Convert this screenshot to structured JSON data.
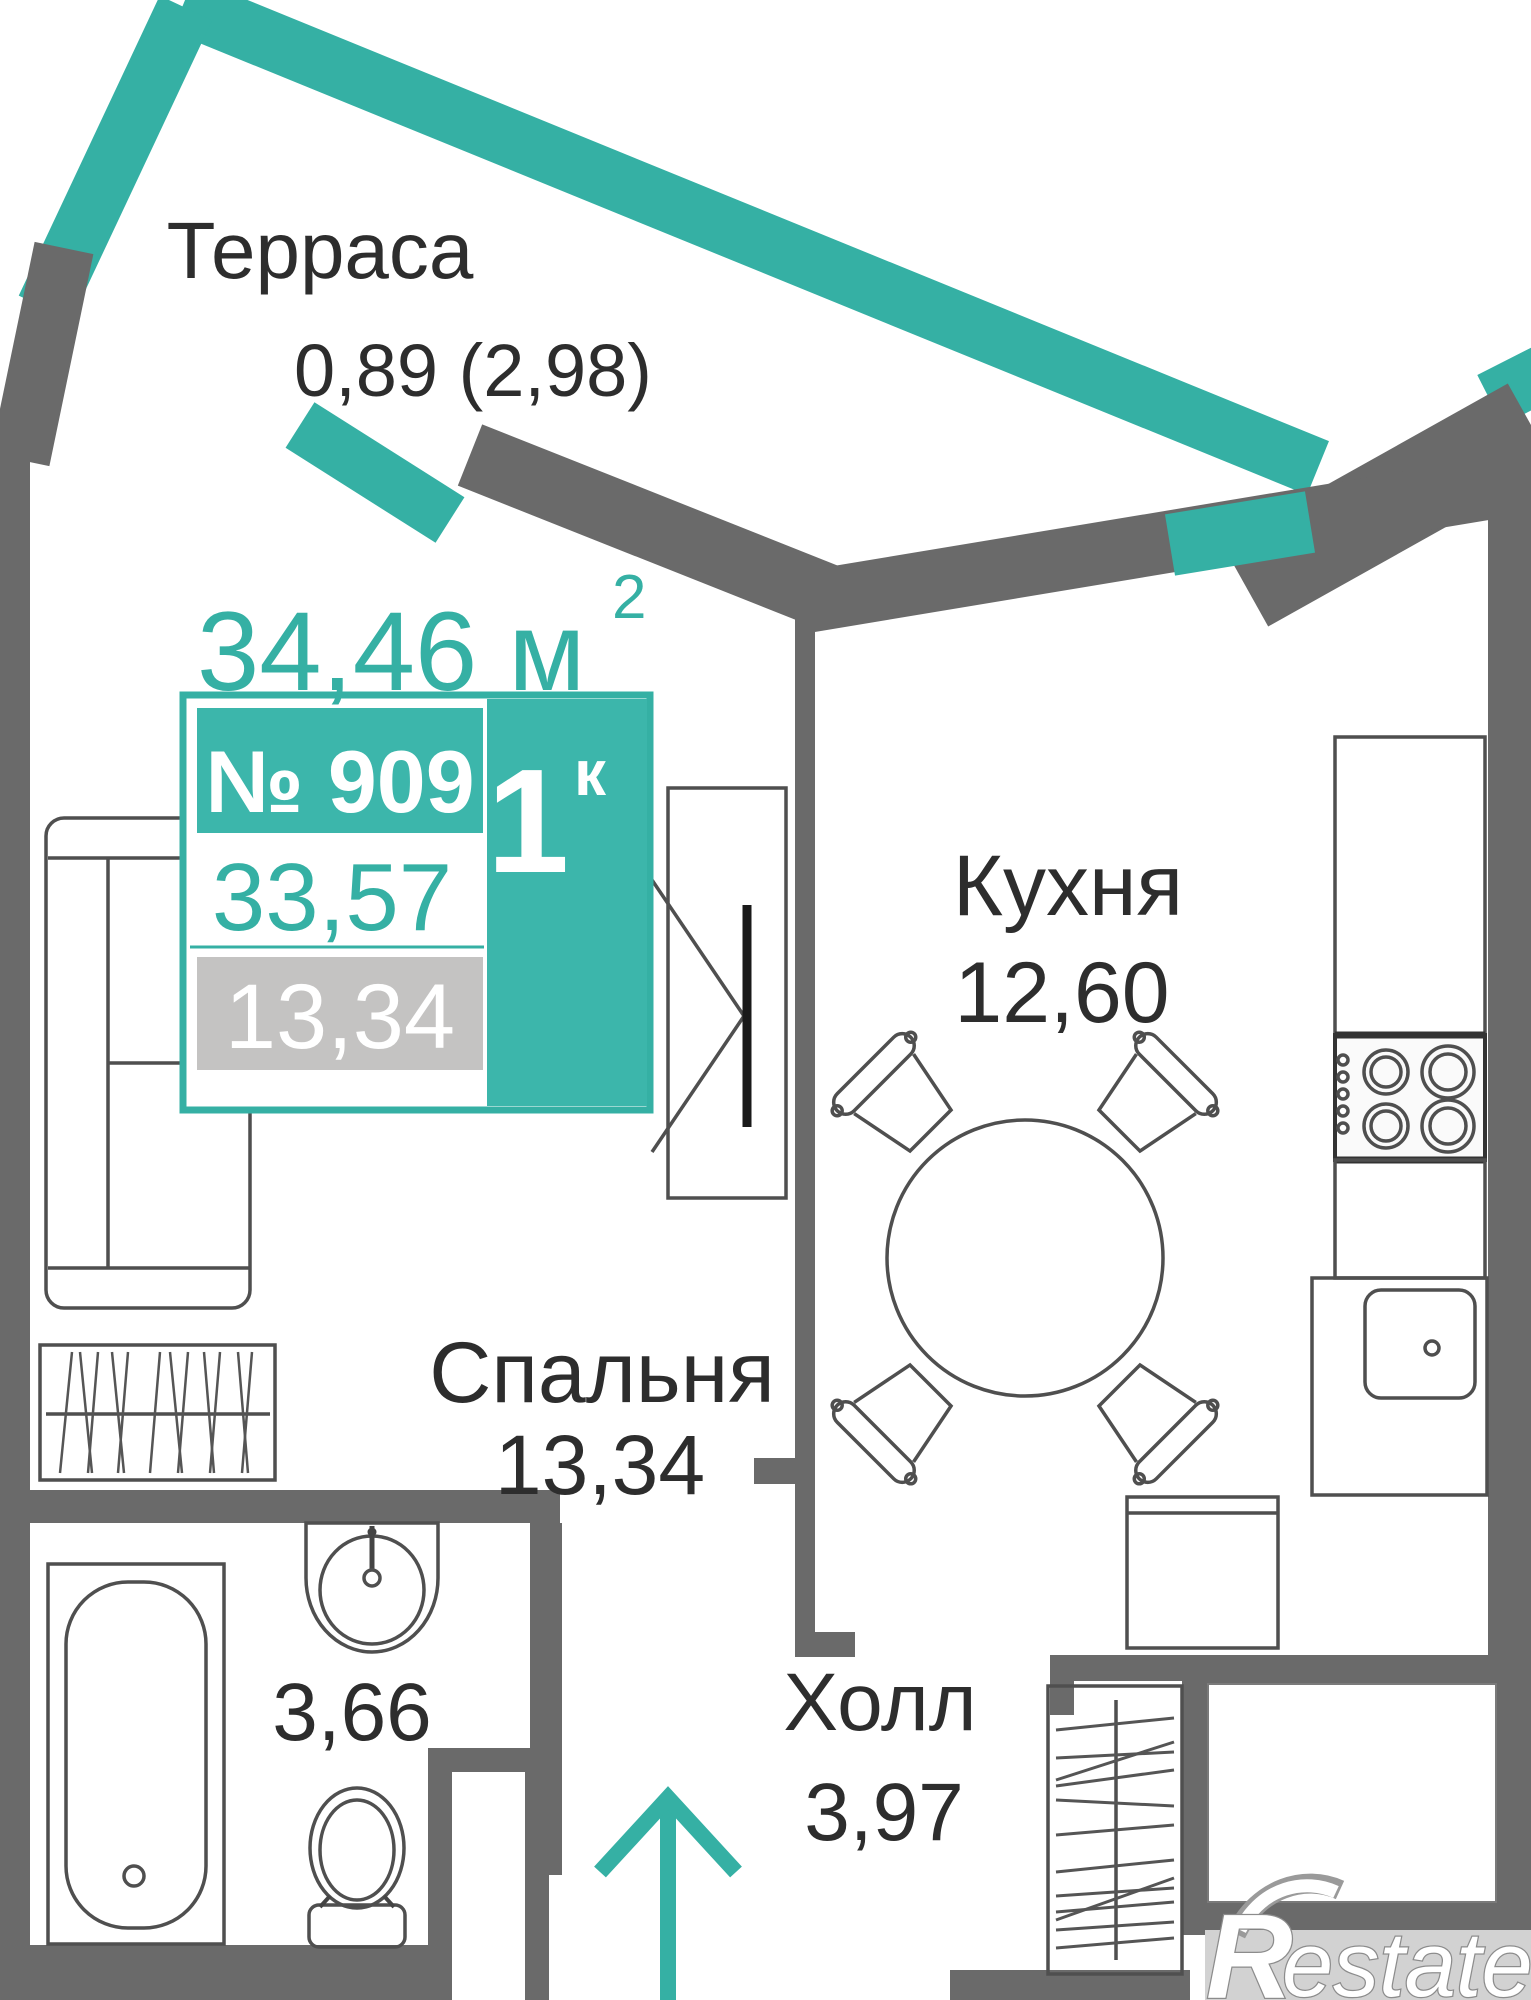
{
  "colors": {
    "teal": "#35b0a4",
    "teal_light": "#3cb6ab",
    "wall_gray": "#6a6a6a",
    "cell_gray": "#c4c3c2",
    "watermark_bg": "#d2d2d2"
  },
  "terrace": {
    "label": "Терраса",
    "area": "0,89 (2,98)"
  },
  "title": {
    "area": "34,46 м",
    "sup": "2"
  },
  "unit_card": {
    "number": "№ 909",
    "rooms": "1",
    "rooms_sup": "к",
    "area_total": "33,57",
    "area_room": "13,34"
  },
  "rooms": {
    "kitchen": {
      "label": "Кухня",
      "area": "12,60"
    },
    "bedroom": {
      "label": "Спальня",
      "area": "13,34"
    },
    "hall": {
      "label": "Холл",
      "area": "3,97"
    },
    "bathroom": {
      "area": "3,66"
    }
  },
  "watermark": {
    "logo_r": "R",
    "logo_rest": "estate"
  }
}
